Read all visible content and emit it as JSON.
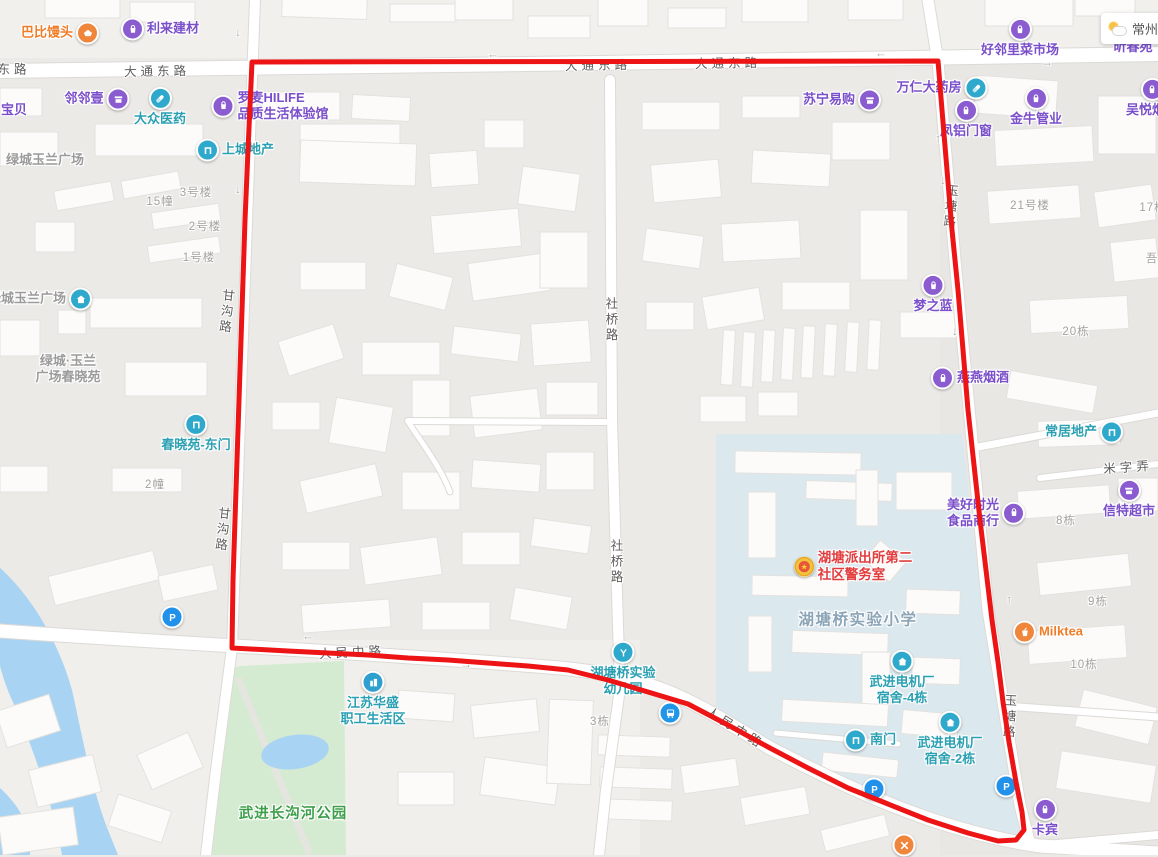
{
  "app": {
    "weather": {
      "city": "常州",
      "icon": "partly-cloudy"
    }
  },
  "boundary": {
    "color": "#ec1414",
    "width": 5,
    "points": "252,62 938,61 942,110 947,170 952,230 958,290 963,350 968,410 974,465 980,520 986,570 992,620 998,662 1003,702 1009,742 1016,782 1022,812 1024,830 1016,840 998,841 968,833 928,820 888,804 848,788 808,768 768,747 728,725 688,704 648,692 608,680 568,670 528,666 488,663 448,660 408,658 368,655 328,653 288,651 232,648 233,580 235,520 237,460 239,400 241,340 243,280 245,220 248,150"
  },
  "road_labels": [
    {
      "text": "东路",
      "x": 14,
      "y": 68,
      "vert": false,
      "rot": 0
    },
    {
      "text": "大通东路",
      "x": 157,
      "y": 70,
      "vert": false,
      "rot": -1
    },
    {
      "text": "大通东路",
      "x": 598,
      "y": 64,
      "vert": false,
      "rot": -1
    },
    {
      "text": "大通东路",
      "x": 728,
      "y": 62,
      "vert": false,
      "rot": -1
    },
    {
      "text": "人民中路",
      "x": 352,
      "y": 651,
      "vert": false,
      "rot": -3
    },
    {
      "text": "人民中路",
      "x": 736,
      "y": 727,
      "vert": false,
      "rot": 32
    },
    {
      "text": "社桥路",
      "x": 611,
      "y": 320,
      "vert": true,
      "rot": 0
    },
    {
      "text": "社桥路",
      "x": 616,
      "y": 562,
      "vert": true,
      "rot": 0
    },
    {
      "text": "甘沟路",
      "x": 226,
      "y": 312,
      "vert": true,
      "rot": 6
    },
    {
      "text": "甘沟路",
      "x": 222,
      "y": 530,
      "vert": true,
      "rot": 6
    },
    {
      "text": "玉塘路",
      "x": 950,
      "y": 207,
      "vert": true,
      "rot": 5
    },
    {
      "text": "玉塘路",
      "x": 1009,
      "y": 717,
      "vert": true,
      "rot": 3
    },
    {
      "text": "米字弄",
      "x": 1128,
      "y": 466,
      "vert": false,
      "rot": -4
    }
  ],
  "building_labels": [
    {
      "text": "3号楼",
      "x": 196,
      "y": 192
    },
    {
      "text": "15幢",
      "x": 160,
      "y": 201
    },
    {
      "text": "2号楼",
      "x": 205,
      "y": 226
    },
    {
      "text": "1号楼",
      "x": 199,
      "y": 257
    },
    {
      "text": "2幢",
      "x": 155,
      "y": 484
    },
    {
      "text": "21号楼",
      "x": 1030,
      "y": 205
    },
    {
      "text": "17栋",
      "x": 1153,
      "y": 207
    },
    {
      "text": "吾",
      "x": 1152,
      "y": 258
    },
    {
      "text": "20栋",
      "x": 1076,
      "y": 331
    },
    {
      "text": "8栋",
      "x": 1066,
      "y": 520
    },
    {
      "text": "9栋",
      "x": 1098,
      "y": 601
    },
    {
      "text": "10栋",
      "x": 1084,
      "y": 664
    },
    {
      "text": "3栋",
      "x": 600,
      "y": 721
    }
  ],
  "arrows": [
    {
      "x": 240,
      "y": 33,
      "rot": 90
    },
    {
      "x": 240,
      "y": 190,
      "rot": 90
    },
    {
      "x": 493,
      "y": 58,
      "rot": 180
    },
    {
      "x": 881,
      "y": 57,
      "rot": 180
    },
    {
      "x": 1047,
      "y": 62,
      "rot": 0
    },
    {
      "x": 936,
      "y": 139,
      "rot": -90
    },
    {
      "x": 945,
      "y": 181,
      "rot": 90
    },
    {
      "x": 308,
      "y": 640,
      "rot": 180
    },
    {
      "x": 466,
      "y": 664,
      "rot": 0
    },
    {
      "x": 992,
      "y": 595,
      "rot": 90
    },
    {
      "x": 1007,
      "y": 600,
      "rot": -90
    },
    {
      "x": 957,
      "y": 332,
      "rot": 90
    },
    {
      "x": 1019,
      "y": 795,
      "rot": 90
    }
  ],
  "pois": [
    {
      "id": "babi-mantou",
      "lines": [
        "巴比馒头"
      ],
      "x": 60,
      "y": 33,
      "iconSide": "right",
      "icon": "bun",
      "iconColor": "#f0853c",
      "cls": "orange"
    },
    {
      "id": "lilai-jiancai",
      "lines": [
        "利来建材"
      ],
      "x": 160,
      "y": 29,
      "iconSide": "left",
      "icon": "bag",
      "iconColor": "#8a5cd0",
      "cls": "purple"
    },
    {
      "id": "linlinyi",
      "lines": [
        "邻邻壹"
      ],
      "x": 97,
      "y": 99,
      "iconSide": "right",
      "icon": "store",
      "iconColor": "#8a5cd0",
      "cls": "purple"
    },
    {
      "id": "baobei",
      "lines": [
        "宝贝"
      ],
      "x": 14,
      "y": 110,
      "iconSide": "none",
      "icon": null,
      "iconColor": null,
      "cls": "purple"
    },
    {
      "id": "dazhong-yiyao",
      "lines": [
        "大众医药"
      ],
      "x": 160,
      "y": 107,
      "iconSide": "top",
      "icon": "pill",
      "iconColor": "#2fa9cb",
      "cls": "teal"
    },
    {
      "id": "luomai-hilife",
      "lines": [
        "罗麦HILIFE",
        "品质生活体验馆"
      ],
      "x": 270,
      "y": 106,
      "iconSide": "left",
      "icon": "bag",
      "iconColor": "#8a5cd0",
      "cls": "purple",
      "align": "left"
    },
    {
      "id": "shangcheng-dichan",
      "lines": [
        "上城地产"
      ],
      "x": 235,
      "y": 150,
      "iconSide": "left",
      "icon": "door",
      "iconColor": "#2fa9cb",
      "cls": "teal"
    },
    {
      "id": "lvcheng-yulan-plaza-top",
      "lines": [
        "绿城玉兰广场"
      ],
      "x": 45,
      "y": 160,
      "iconSide": "none",
      "icon": null,
      "iconColor": null,
      "cls": "gray13"
    },
    {
      "id": "haolinli-market",
      "lines": [
        "好邻里菜市场"
      ],
      "x": 1020,
      "y": 38,
      "iconSide": "top",
      "icon": "bag",
      "iconColor": "#8a5cd0",
      "cls": "purple"
    },
    {
      "id": "xinchun",
      "lines": [
        "昕春苑"
      ],
      "x": 1133,
      "y": 47,
      "iconSide": "none",
      "icon": null,
      "iconColor": null,
      "cls": "purple"
    },
    {
      "id": "suning-yigou",
      "lines": [
        "苏宁易购"
      ],
      "x": 842,
      "y": 100,
      "iconSide": "right",
      "icon": "store",
      "iconColor": "#8a5cd0",
      "cls": "purple"
    },
    {
      "id": "wanren-dayaofang",
      "lines": [
        "万仁大药房"
      ],
      "x": 942,
      "y": 88,
      "iconSide": "right",
      "icon": "pill",
      "iconColor": "#2fa9cb",
      "cls": "purple"
    },
    {
      "id": "fenglv-menchuang",
      "lines": [
        "凤铝门窗"
      ],
      "x": 966,
      "y": 119,
      "iconSide": "top",
      "icon": "bag",
      "iconColor": "#8a5cd0",
      "cls": "purple"
    },
    {
      "id": "jinniu-guanye",
      "lines": [
        "金牛管业"
      ],
      "x": 1036,
      "y": 107,
      "iconSide": "top",
      "icon": "bag",
      "iconColor": "#8a5cd0",
      "cls": "purple"
    },
    {
      "id": "wuyue-yanjiu",
      "lines": [
        "吴悦烟酒"
      ],
      "x": 1152,
      "y": 98,
      "iconSide": "top",
      "icon": "bag",
      "iconColor": "#8a5cd0",
      "cls": "purple"
    },
    {
      "id": "mengzhilan",
      "lines": [
        "梦之蓝"
      ],
      "x": 933,
      "y": 294,
      "iconSide": "top",
      "icon": "bag",
      "iconColor": "#8a5cd0",
      "cls": "purple"
    },
    {
      "id": "yanyan-yanjiu",
      "lines": [
        "燕燕烟酒"
      ],
      "x": 970,
      "y": 378,
      "iconSide": "left",
      "icon": "bag",
      "iconColor": "#8a5cd0",
      "cls": "purple"
    },
    {
      "id": "changju-dichan",
      "lines": [
        "常居地产"
      ],
      "x": 1084,
      "y": 432,
      "iconSide": "right",
      "icon": "door",
      "iconColor": "#2fa9cb",
      "cls": "teal"
    },
    {
      "id": "meihao-shiguang",
      "lines": [
        "美好时光",
        "食品商行"
      ],
      "x": 986,
      "y": 513,
      "iconSide": "right",
      "icon": "bag",
      "iconColor": "#8a5cd0",
      "cls": "purple"
    },
    {
      "id": "xinte-chaoshi",
      "lines": [
        "信特超市"
      ],
      "x": 1129,
      "y": 499,
      "iconSide": "top",
      "icon": "store",
      "iconColor": "#8a5cd0",
      "cls": "purple"
    },
    {
      "id": "milktea",
      "lines": [
        "Milktea"
      ],
      "x": 1048,
      "y": 632,
      "iconSide": "left",
      "icon": "cup",
      "iconColor": "#f0853c",
      "cls": "orange"
    },
    {
      "id": "kabin",
      "lines": [
        "卡宾"
      ],
      "x": 1045,
      "y": 818,
      "iconSide": "top",
      "icon": "bag",
      "iconColor": "#8a5cd0",
      "cls": "purple"
    },
    {
      "id": "parking-1",
      "lines": [],
      "x": 172,
      "y": 617,
      "iconSide": "only",
      "icon": "parking",
      "iconColor": "#2191ea",
      "cls": "teal"
    },
    {
      "id": "parking-2",
      "lines": [],
      "x": 874,
      "y": 789,
      "iconSide": "only",
      "icon": "parking",
      "iconColor": "#2191ea",
      "cls": "teal"
    },
    {
      "id": "parking-3",
      "lines": [],
      "x": 1006,
      "y": 786,
      "iconSide": "only",
      "icon": "parking",
      "iconColor": "#2191ea",
      "cls": "teal"
    },
    {
      "id": "closed-marker",
      "lines": [],
      "x": 904,
      "y": 845,
      "iconSide": "only",
      "icon": "close",
      "iconColor": "#f0853c",
      "cls": "orange"
    },
    {
      "id": "bus-stop",
      "lines": [],
      "x": 670,
      "y": 713,
      "iconSide": "only",
      "icon": "bus",
      "iconColor": "#2196e8",
      "cls": "teal"
    },
    {
      "id": "hutangqiao-kindergarten",
      "lines": [
        "湖塘桥实验",
        "幼儿园"
      ],
      "x": 623,
      "y": 669,
      "iconSide": "top",
      "icon": "kindergarten",
      "iconColor": "#2fa9cb",
      "cls": "teal"
    },
    {
      "id": "jiangsu-huasheng",
      "lines": [
        "江苏华盛",
        "职工生活区"
      ],
      "x": 373,
      "y": 699,
      "iconSide": "top",
      "icon": "building",
      "iconColor": "#2f9fd0",
      "cls": "teal"
    },
    {
      "id": "wujin-dianjichang-dorm4",
      "lines": [
        "武进电机厂",
        "宿舍-4栋"
      ],
      "x": 902,
      "y": 678,
      "iconSide": "top",
      "icon": "house",
      "iconColor": "#2fa9cb",
      "cls": "teal"
    },
    {
      "id": "wujin-dianjichang-dorm2",
      "lines": [
        "武进电机厂",
        "宿舍-2栋"
      ],
      "x": 950,
      "y": 739,
      "iconSide": "top",
      "icon": "house",
      "iconColor": "#2fa9cb",
      "cls": "teal"
    },
    {
      "id": "south-gate",
      "lines": [
        "南门"
      ],
      "x": 870,
      "y": 740,
      "iconSide": "left",
      "icon": "door",
      "iconColor": "#2fa9cb",
      "cls": "teal"
    },
    {
      "id": "chunxiaoyuan-east-gate",
      "lines": [
        "春晓苑-东门"
      ],
      "x": 196,
      "y": 433,
      "iconSide": "top",
      "icon": "door",
      "iconColor": "#2fa9cb",
      "cls": "teal"
    },
    {
      "id": "lvcheng-yulan-plaza",
      "lines": [
        "绿城玉兰广场"
      ],
      "x": 40,
      "y": 299,
      "iconSide": "right",
      "icon": "house",
      "iconColor": "#2fa9cb",
      "cls": "gray13"
    },
    {
      "id": "police-room",
      "lines": [
        "湖塘派出所第二",
        "社区警务室"
      ],
      "x": 853,
      "y": 567,
      "iconSide": "left",
      "icon": "police",
      "iconColor": "#f3c33e",
      "cls": "red",
      "align": "left"
    },
    {
      "id": "hutangqiao-primary-school",
      "lines": [
        "湖塘桥实验小学"
      ],
      "x": 858,
      "y": 620,
      "iconSide": "none",
      "icon": null,
      "iconColor": null,
      "cls": "edu"
    },
    {
      "id": "lvcheng-chunxiaoyuan",
      "lines": [
        "绿城·玉兰",
        "广场春晓苑"
      ],
      "x": 68,
      "y": 369,
      "iconSide": "none",
      "icon": null,
      "iconColor": null,
      "cls": "gray13"
    },
    {
      "id": "changgou-park",
      "lines": [
        "武进长沟河公园"
      ],
      "x": 293,
      "y": 814,
      "iconSide": "none",
      "icon": null,
      "iconColor": null,
      "cls": "green"
    }
  ]
}
